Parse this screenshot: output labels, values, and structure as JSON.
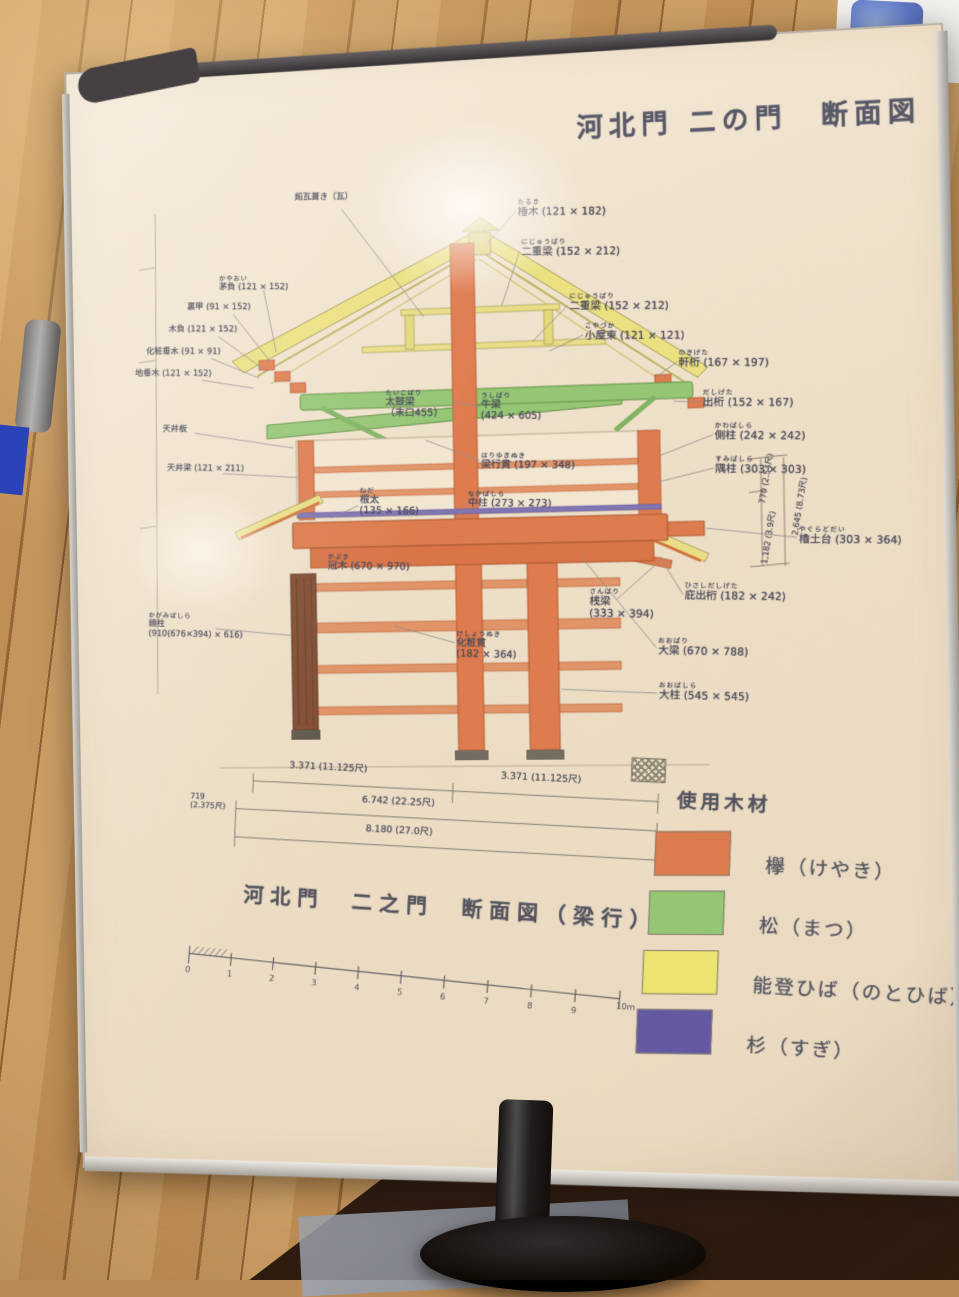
{
  "sign": {
    "title": "河北門 二の門　断面図",
    "caption": "河北門　二之門　断面図（梁行）",
    "legend": {
      "heading": "使用木材",
      "items": [
        {
          "name": "keyaki",
          "label": "欅（けやき）",
          "color": "#dc7a4e"
        },
        {
          "name": "matsu",
          "label": "松（まつ）",
          "color": "#8fc877"
        },
        {
          "name": "notohiba",
          "label": "能登ひば（のとひば）",
          "color": "#ece873"
        },
        {
          "name": "sugi",
          "label": "杉（すぎ）",
          "color": "#5d55a8"
        }
      ]
    },
    "annotations": [
      {
        "text": "棰木 (121 × 182)",
        "furi": "たるき",
        "x": 465,
        "y": 150,
        "cls": "r",
        "line": [
          463,
          162,
          434,
          193
        ]
      },
      {
        "text": "二重梁 (152 × 212)",
        "furi": "にじゅうばり",
        "x": 468,
        "y": 190,
        "cls": "r",
        "line": [
          466,
          202,
          447,
          256
        ]
      },
      {
        "text": "二重梁 (152 × 212)",
        "furi": "にじゅうばり",
        "x": 515,
        "y": 246,
        "cls": "r",
        "line": [
          513,
          258,
          477,
          293
        ]
      },
      {
        "text": "小屋束 (121 × 121)",
        "furi": "こやづか",
        "x": 530,
        "y": 276,
        "cls": "r",
        "line": [
          528,
          288,
          494,
          303
        ]
      },
      {
        "text": "軒桁 (167 × 197)",
        "furi": "のきげた",
        "x": 622,
        "y": 306,
        "cls": "r",
        "line": [
          620,
          318,
          600,
          332
        ]
      },
      {
        "text": "出桁 (152 × 167)",
        "furi": "だしげた",
        "x": 645,
        "y": 346,
        "cls": "r",
        "line": [
          643,
          358,
          616,
          357
        ]
      },
      {
        "text": "側柱 (242 × 242)",
        "furi": "かわばしら",
        "x": 656,
        "y": 379,
        "cls": "r",
        "line": [
          654,
          391,
          602,
          410
        ]
      },
      {
        "text": "隅柱 (303 × 303)",
        "furi": "すみばしら",
        "x": 656,
        "y": 412,
        "cls": "r",
        "line": [
          654,
          424,
          600,
          436
        ]
      },
      {
        "text": "櫓土台 (303 × 364)",
        "furi": "やぐらどだい",
        "x": 736,
        "y": 483,
        "cls": "r",
        "line": [
          734,
          494,
          646,
          483
        ]
      },
      {
        "text": "庇出桁 (182 × 242)",
        "furi": "ひさしだしげた",
        "x": 624,
        "y": 536,
        "cls": "r",
        "line": [
          622,
          548,
          600,
          510
        ]
      },
      {
        "text": "大梁 (670 × 788)",
        "furi": "おおばり",
        "x": 597,
        "y": 590,
        "cls": "r",
        "line": [
          595,
          600,
          520,
          506
        ]
      },
      {
        "text": "大柱 (545 × 545)",
        "furi": "おおばしら",
        "x": 597,
        "y": 634,
        "cls": "r",
        "line": [
          595,
          645,
          500,
          640
        ]
      },
      {
        "text": "桟梁\n(333 × 394)",
        "furi": "さんばり",
        "x": 530,
        "y": 540,
        "cls": "r",
        "line": [
          556,
          552,
          600,
          514
        ]
      },
      {
        "text": "太鼓梁\n（末口455）",
        "furi": "たいこばり",
        "x": 328,
        "y": 336,
        "cls": "c"
      },
      {
        "text": "牛梁\n(424 × 605)",
        "furi": "うしばり",
        "x": 425,
        "y": 342,
        "cls": "c",
        "line": [
          423,
          356,
          397,
          350
        ]
      },
      {
        "text": "梁行貫 (197 × 348)",
        "furi": "はりゆきぬき",
        "x": 424,
        "y": 402,
        "cls": "c",
        "line": [
          422,
          410,
          368,
          388
        ]
      },
      {
        "text": "中柱 (273 × 273)",
        "furi": "なかばしら",
        "x": 410,
        "y": 440,
        "cls": "c",
        "line": [
          408,
          452,
          398,
          468
        ]
      },
      {
        "text": "根太\n(135 × 166)",
        "furi": "ねだ",
        "x": 300,
        "y": 434,
        "cls": "c",
        "line": [
          298,
          452,
          270,
          464
        ]
      },
      {
        "text": "冠木 (670 × 970)",
        "furi": "かぶき",
        "x": 266,
        "y": 500,
        "cls": "c"
      },
      {
        "text": "化粧貫\n(182 × 364)",
        "furi": "けしょうぬき",
        "x": 396,
        "y": 580,
        "cls": "c",
        "line": [
          394,
          592,
          332,
          574
        ]
      },
      {
        "text": "鉛瓦葺き（瓦）",
        "x": 238,
        "y": 133,
        "cls": "l",
        "line": [
          286,
          152,
          368,
          264
        ]
      },
      {
        "text": "茅負 (121 × 152)",
        "furi": "かやおい",
        "x": 158,
        "y": 214,
        "cls": "l",
        "line": [
          204,
          230,
          216,
          294
        ]
      },
      {
        "text": "裏甲 (91 × 152)",
        "x": 124,
        "y": 240,
        "cls": "l",
        "line": [
          172,
          254,
          210,
          304
        ]
      },
      {
        "text": "木負 (121 × 152)",
        "x": 104,
        "y": 262,
        "cls": "l",
        "line": [
          156,
          276,
          204,
          312
        ]
      },
      {
        "text": "化粧垂木 (91 × 91)",
        "x": 80,
        "y": 284,
        "cls": "l",
        "line": [
          148,
          298,
          198,
          320
        ]
      },
      {
        "text": "地垂木 (121 × 152)",
        "x": 68,
        "y": 306,
        "cls": "l",
        "line": [
          138,
          320,
          192,
          330
        ]
      },
      {
        "text": "天井板",
        "x": 96,
        "y": 364,
        "cls": "l",
        "line": [
          130,
          374,
          232,
          392
        ]
      },
      {
        "text": "天井梁 (121 × 211)",
        "x": 100,
        "y": 404,
        "cls": "l",
        "line": [
          158,
          416,
          236,
          422
        ]
      },
      {
        "text": "鏡柱\n(910(676×394) × 616)",
        "furi": "かがみばしら",
        "x": 78,
        "y": 556,
        "cls": "l",
        "line": [
          148,
          574,
          226,
          582
        ]
      }
    ],
    "dim_right": [
      {
        "text": "770 (2.54尺)",
        "x": 680,
        "y": 430
      },
      {
        "text": "2,645 (8.73尺)",
        "x": 708,
        "y": 458
      },
      {
        "text": "1,182 (3.9尺)",
        "x": 680,
        "y": 488
      }
    ],
    "dims_bottom": {
      "seg_left": "3.371 (11.125尺)",
      "seg_right": "3.371 (11.125尺)",
      "total_mid": "6.742 (22.25尺)",
      "total": "8.180 (27.0尺)",
      "end_left": "719\n(2.375尺)",
      "end_right": "719\n(2.375尺)"
    },
    "scale": {
      "ticks": [
        "0",
        "1",
        "2",
        "3",
        "4",
        "5",
        "6",
        "7",
        "8",
        "9"
      ],
      "end_label": "10m"
    }
  }
}
